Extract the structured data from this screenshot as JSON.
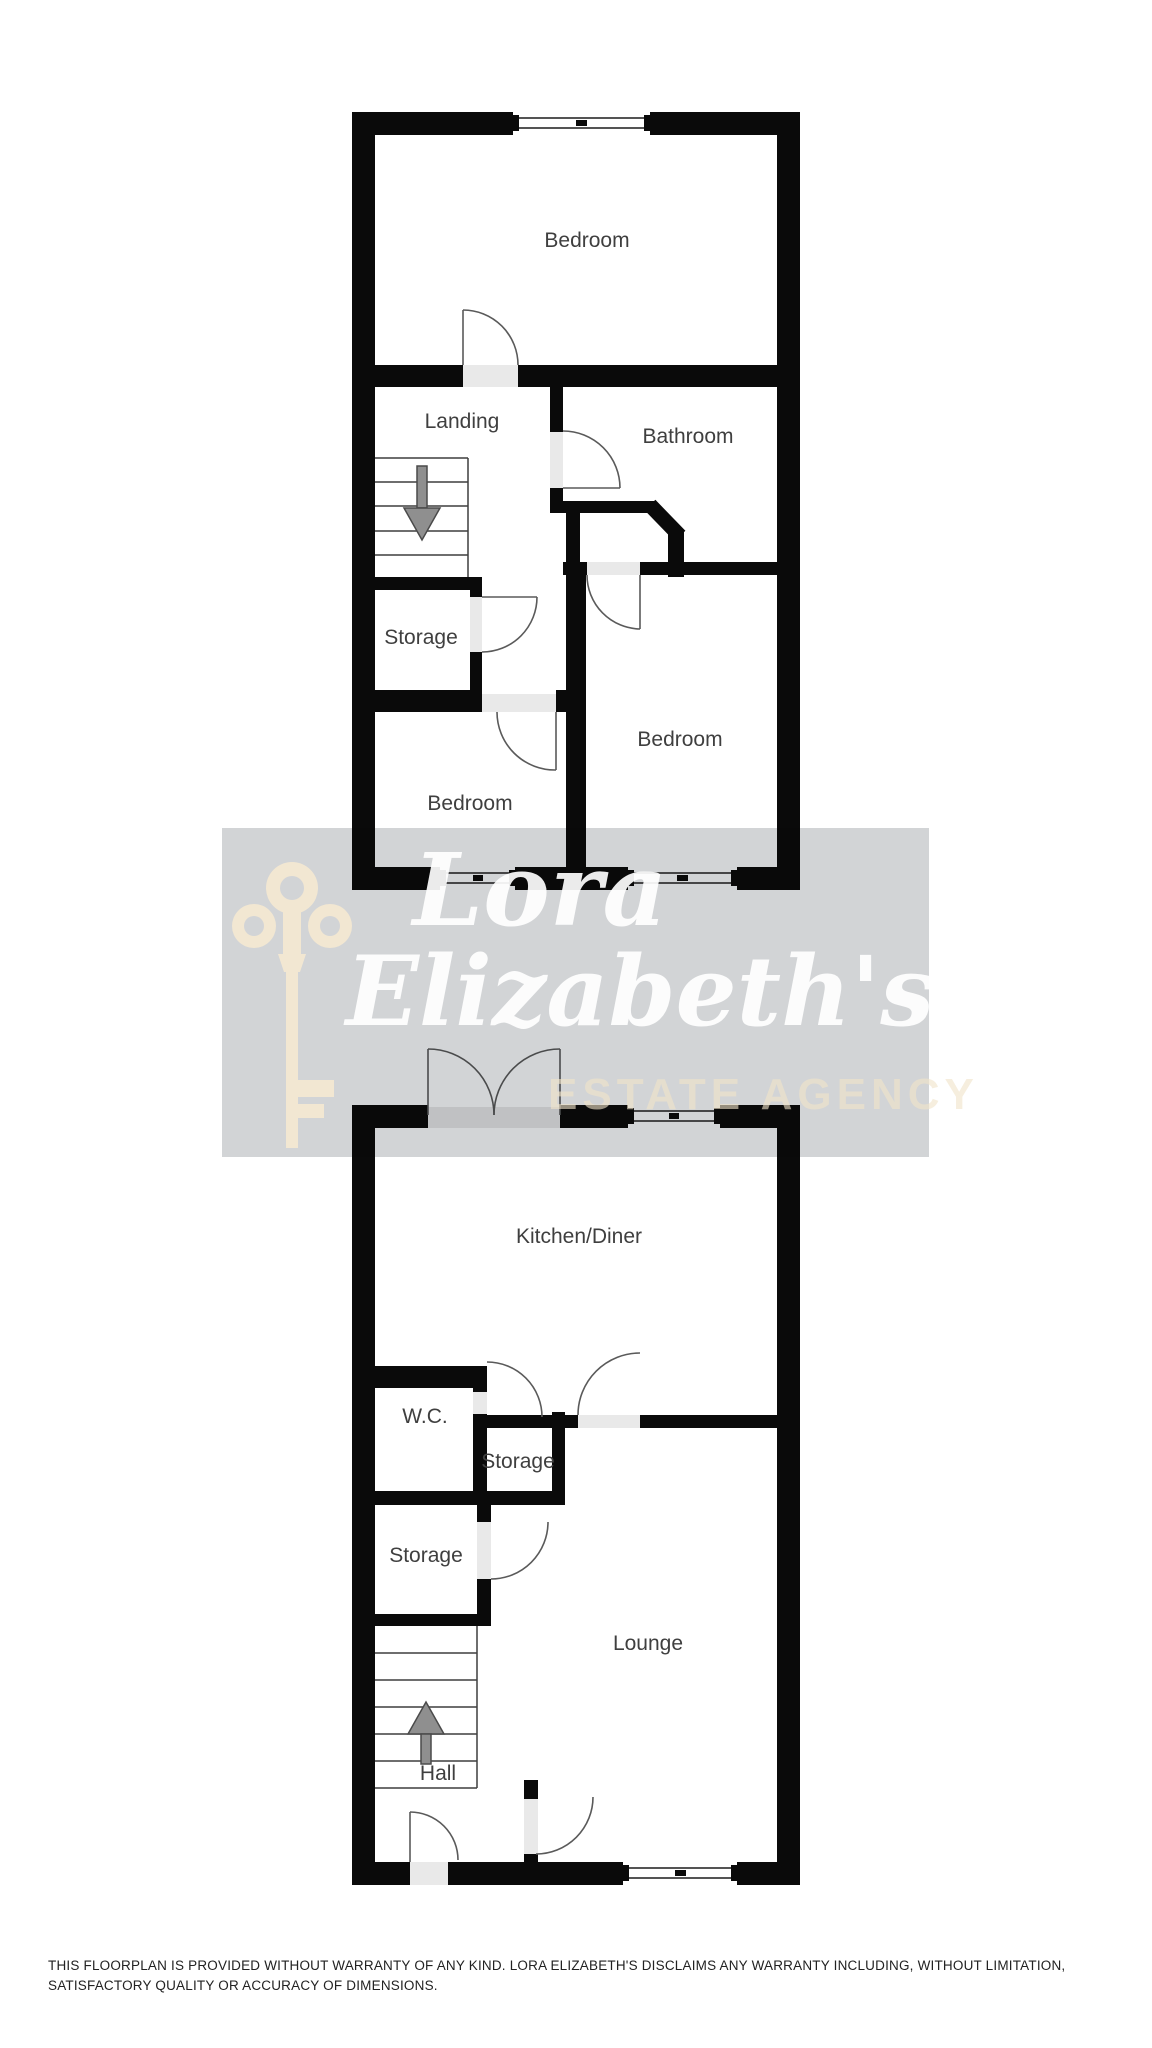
{
  "first_floor": {
    "rooms": {
      "bedroom_top": "Bedroom",
      "landing": "Landing",
      "bathroom": "Bathroom",
      "storage": "Storage",
      "bedroom_left": "Bedroom",
      "bedroom_right": "Bedroom"
    },
    "stairs_direction": "down"
  },
  "ground_floor": {
    "rooms": {
      "kitchen": "Kitchen/Diner",
      "wc": "W.C.",
      "storage_small": "Storage",
      "storage": "Storage",
      "lounge": "Lounge",
      "hall": "Hall"
    },
    "stairs_direction": "up"
  },
  "watermark": {
    "script_line1": "Lora",
    "script_line2": "Elizabeth's",
    "agency_line": "ESTATE AGENCY"
  },
  "disclaimer": {
    "line1": "THIS FLOORPLAN IS PROVIDED WITHOUT WARRANTY OF ANY KIND. LORA ELIZABETH'S DISCLAIMS ANY WARRANTY INCLUDING, WITHOUT LIMITATION,",
    "line2": "SATISFACTORY QUALITY OR ACCURACY OF DIMENSIONS."
  },
  "icons": {
    "logo": "key-logo-icon",
    "first_floor_stairs": "stairs-down-arrow-icon",
    "ground_floor_stairs": "stairs-up-arrow-icon"
  },
  "colors": {
    "wall": "#0a0a0a",
    "floor": "#ffffff",
    "watermark_band": "#d2d4d6",
    "watermark_key": "#f2e7d2",
    "watermark_script": "#ffffff",
    "watermark_agency": "#efe3c8",
    "room_label_text": "#3f3f3f",
    "disclaimer_text": "#222222",
    "door_threshold": "#e9e9e9",
    "stairs_arrow": "#8f8f8f"
  }
}
